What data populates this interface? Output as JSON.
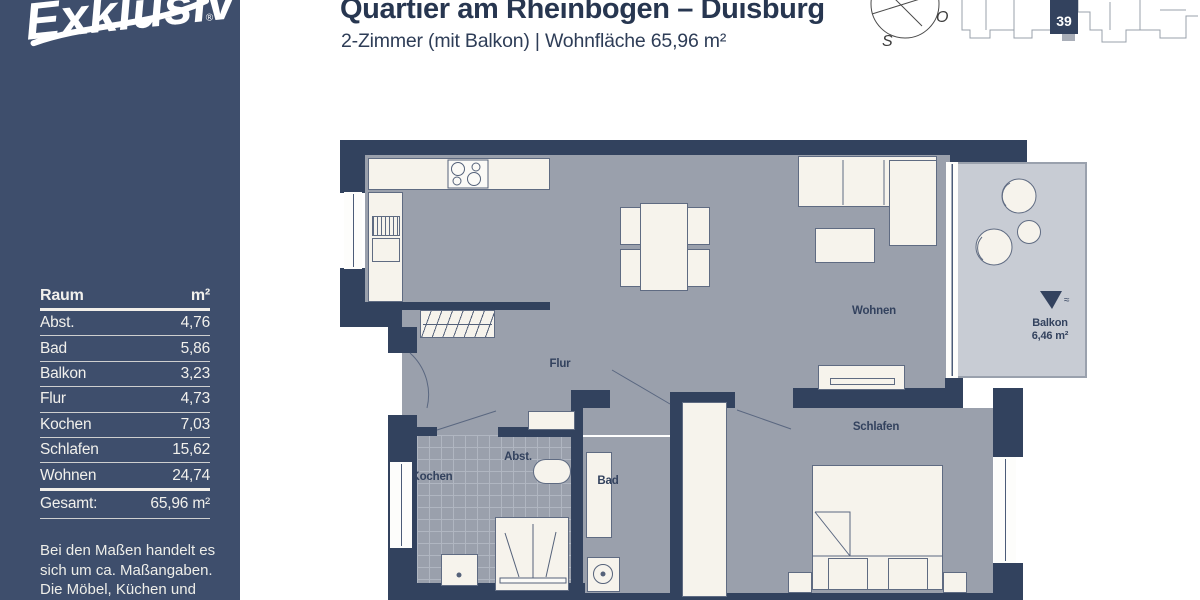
{
  "colors": {
    "sidebar_navy": "#3e4e6c",
    "wall_navy": "#32425e",
    "floor_gray": "#9aa0ac",
    "balcony_gray": "#c8ccd4",
    "furniture_cream": "#f6f3ec",
    "title_navy": "#273650"
  },
  "brand": {
    "logo": "Exklusiv",
    "registered": "®"
  },
  "header": {
    "title": "Quartier am Rheinbogen – Duisburg",
    "subtitle": "2-Zimmer (mit Balkon) | Wohnfläche 65,96 m²"
  },
  "compass": {
    "east_label": "O",
    "south_label": "S"
  },
  "site_plan": {
    "highlighted_unit": "39"
  },
  "area_table": {
    "col_room": "Raum",
    "col_area": "m²",
    "rows": [
      {
        "room": "Abst.",
        "area": "4,76"
      },
      {
        "room": "Bad",
        "area": "5,86"
      },
      {
        "room": "Balkon",
        "area": "3,23"
      },
      {
        "room": "Flur",
        "area": "4,73"
      },
      {
        "room": "Kochen",
        "area": "7,03"
      },
      {
        "room": "Schlafen",
        "area": "15,62"
      },
      {
        "room": "Wohnen",
        "area": "24,74"
      }
    ],
    "total_label": "Gesamt:",
    "total_value": "65,96 m²"
  },
  "disclaimer": {
    "line1": "Bei den Maßen handelt es",
    "line2": "sich um ca. Maßangaben.",
    "line3": "Die Möbel, Küchen und",
    "line4": "Sanitärobjekte dienen der"
  },
  "floor_plan": {
    "labels": {
      "flur": "Flur",
      "kochen": "Kochen",
      "abst": "Abst.",
      "bad": "Bad",
      "wohnen": "Wohnen",
      "schlafen": "Schlafen",
      "balkon": "Balkon",
      "balkon_area": "6,46 m²",
      "drain_mark": "≈"
    }
  }
}
